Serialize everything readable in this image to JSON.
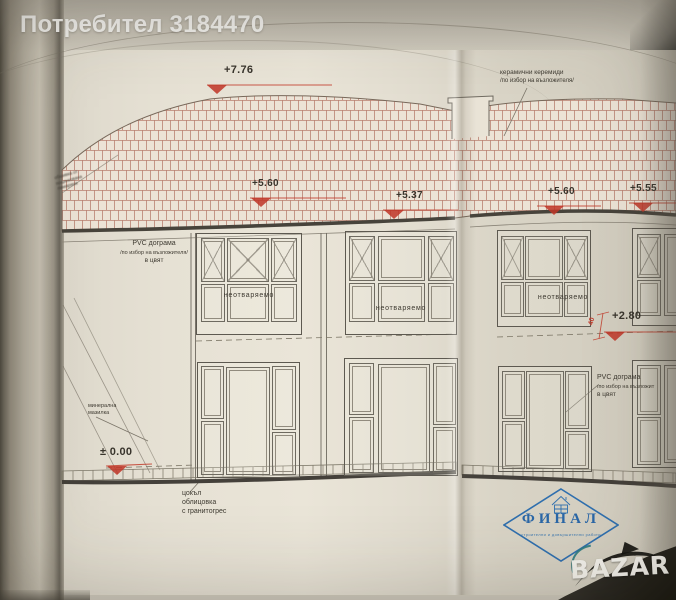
{
  "header": {
    "watermark": "Потребител 3184470"
  },
  "drawing": {
    "markers": {
      "roof_ridge": "+7.76",
      "eaves_left": "+5.60",
      "eaves_mid": "+5.37",
      "eaves_right1": "+5.60",
      "eaves_right2": "+5.55",
      "level_280": "+2.80",
      "ground": "± 0.00",
      "dim_40": "40"
    },
    "annotations": {
      "roof_l1": "керамични керемиди",
      "roof_l2": "/по избор на възложителя/",
      "pvc_l1": "PVC дограма",
      "pvc_l2": "/по избор на възложителя/",
      "pvc_l3": "в цвят",
      "fixed": "неотваряемо",
      "plaster_l1": "минерална",
      "plaster_l2": "мазилка",
      "plinth_l1": "цокъл",
      "plinth_l2": "облицовка",
      "plinth_l3": "с гранитогрес",
      "pvc_r1": "PVC дограма",
      "pvc_r2": "/по избор на възложит",
      "pvc_r3": "в цвят",
      "edge_l1": "обшивка от",
      "edge_l2": "поцинкована",
      "edge_l3": "ламарина"
    }
  },
  "stamp": {
    "title": "ФИНАЛ",
    "tagline": "строителни и довършителни работи"
  },
  "site_logo": {
    "text": "BAZAR"
  },
  "colors": {
    "marker_red": "#c03527",
    "tile_line": "#a8604f",
    "stamp_blue": "#2b67a7",
    "ink": "#5d5950"
  }
}
